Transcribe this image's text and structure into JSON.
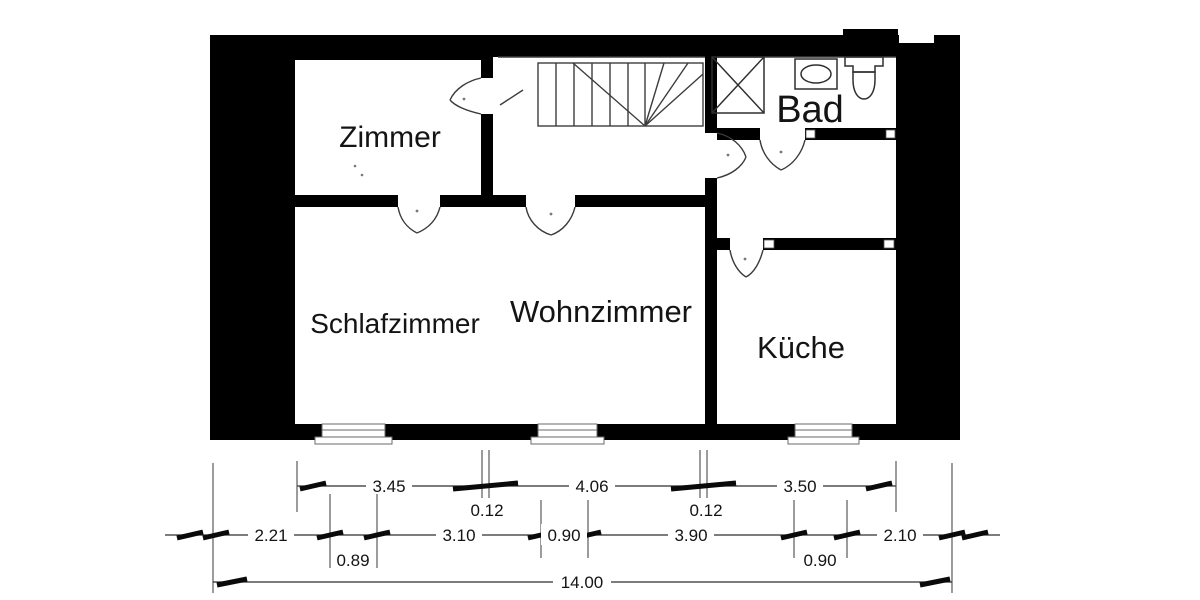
{
  "plan": {
    "rooms": [
      {
        "id": "zimmer",
        "label": "Zimmer"
      },
      {
        "id": "bad",
        "label": "Bad"
      },
      {
        "id": "schlafzimmer",
        "label": "Schlafzimmer"
      },
      {
        "id": "wohnzimmer",
        "label": "Wohnzimmer"
      },
      {
        "id": "kueche",
        "label": "Küche"
      }
    ],
    "fixtures": [
      {
        "name": "staircase"
      },
      {
        "name": "shower"
      },
      {
        "name": "washbasin"
      },
      {
        "name": "toilet"
      },
      {
        "name": "window"
      },
      {
        "name": "door-swing"
      }
    ]
  },
  "dimensions": {
    "row_top": [
      {
        "value": "3.45"
      },
      {
        "value": "4.06"
      },
      {
        "value": "3.50"
      }
    ],
    "wall_thickness": [
      {
        "value": "0.12"
      },
      {
        "value": "0.12"
      }
    ],
    "row_middle": [
      {
        "value": "2.21"
      },
      {
        "value": "3.10"
      },
      {
        "value": "0.90"
      },
      {
        "value": "3.90"
      },
      {
        "value": "2.10"
      }
    ],
    "row_lower": [
      {
        "value": "0.89"
      },
      {
        "value": "0.90"
      }
    ],
    "total": {
      "value": "14.00"
    }
  },
  "colors": {
    "wall": "#000000",
    "line": "#3d3d3d",
    "dim": "#2e2e2e",
    "text": "#141414",
    "bg": "#ffffff"
  }
}
